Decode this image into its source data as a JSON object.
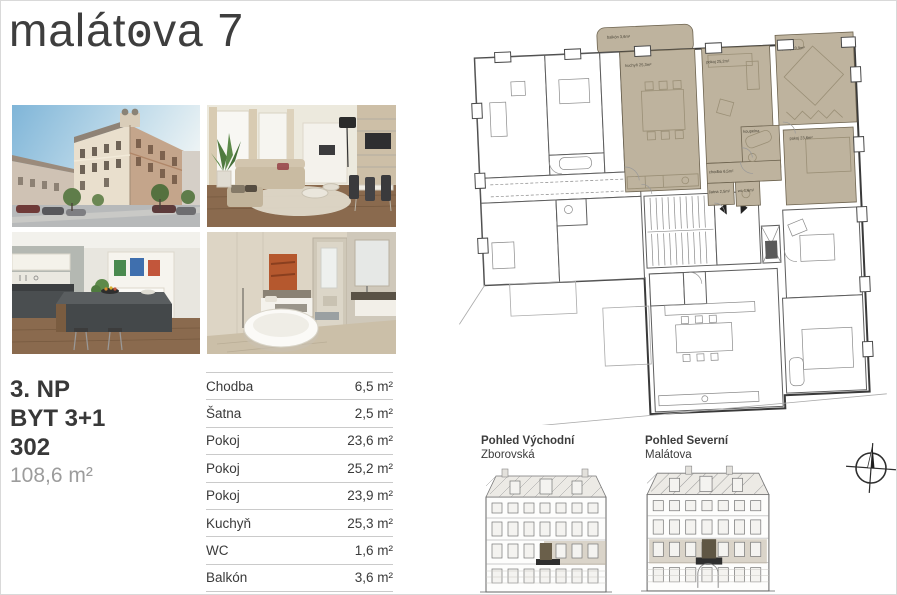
{
  "page": {
    "title_pre": "malát",
    "title_o": "o",
    "title_post": "va 7"
  },
  "unit": {
    "floor": "3. NP",
    "layout": "BYT 3+1",
    "number": "302",
    "area": "108,6 m²"
  },
  "rooms": [
    {
      "label": "Chodba",
      "area": "6,5 m²"
    },
    {
      "label": "Šatna",
      "area": "2,5 m²"
    },
    {
      "label": "Pokoj",
      "area": "23,6 m²"
    },
    {
      "label": "Pokoj",
      "area": "25,2 m²"
    },
    {
      "label": "Pokoj",
      "area": "23,9 m²"
    },
    {
      "label": "Kuchyň",
      "area": "25,3 m²"
    },
    {
      "label": "WC",
      "area": "1,6 m²"
    },
    {
      "label": "Balkón",
      "area": "3,6 m²"
    }
  ],
  "plan": {
    "highlight_color": "#beb39e",
    "labels": {
      "balkon": "balkón 3,6m²",
      "kuchyn": "kuchyň 25,3m²",
      "pokoj1": "pokoj 25,2m²",
      "pokoj2": "pokoj 23,9m²",
      "pokoj3": "pokoj 23,6m²",
      "koupelna": "koupelna",
      "satna": "šatna 2,5m²",
      "wc": "wc 1,6m²",
      "chodba": "chodba 6,5m²"
    }
  },
  "elevations": [
    {
      "title": "Pohled Východní",
      "subtitle": "Zborovská"
    },
    {
      "title": "Pohled Severní",
      "subtitle": "Malátova"
    }
  ]
}
